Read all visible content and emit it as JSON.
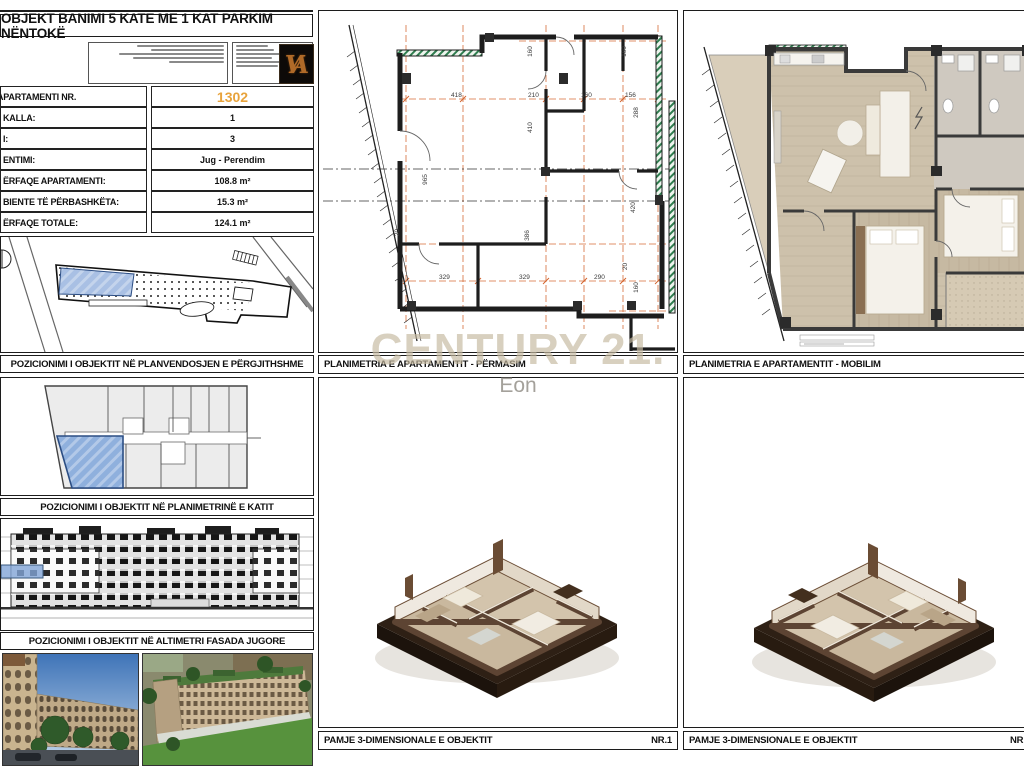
{
  "sheet_title": "OBJEKT BANIMI 5 KATE ME 1 KAT PARKIM NËNTOKË",
  "watermark": {
    "line1": "CENTURY 21.",
    "line2": "Eon"
  },
  "logo_monogram": "VA",
  "info_table": {
    "rows": [
      {
        "label": "APARTAMENTI NR.",
        "value": "1302",
        "accent": true
      },
      {
        "label": "KALLA:",
        "value": "1",
        "accent": false
      },
      {
        "label": "I:",
        "value": "3",
        "accent": false
      },
      {
        "label": "ENTIMI:",
        "value": "Jug - Perendim",
        "accent": false
      },
      {
        "label": "ËRFAQE APARTAMENTI:",
        "value": "108.8 m²",
        "accent": false
      },
      {
        "label": "BIENTE TË PËRBASHKËTA:",
        "value": "15.3 m²",
        "accent": false
      },
      {
        "label": "ËRFAQE TOTALE:",
        "value": "124.1 m²",
        "accent": false
      }
    ]
  },
  "captions": {
    "site_plan": "POZICIONIMI I OBJEKTIT NË PLANVENDOSJEN E PËRGJITHSHME",
    "floor_plan": "POZICIONIMI I OBJEKTIT NË PLANIMETRINË E KATIT",
    "elevation": "POZICIONIMI I OBJEKTIT NË ALTIMETRI FASADA JUGORE",
    "dim_plan": "PLANIMETRIA E APARTAMENTIT - PËRMASIM",
    "furnished_plan": "PLANIMETRIA E APARTAMENTIT - MOBILIM",
    "view3d": "PAMJE 3-DIMENSIONALE E OBJEKTIT",
    "view3d_left_number": "NR.1",
    "view3d_right_number": "NR"
  },
  "colors": {
    "accent_orange": "#E8A33C",
    "grid_orange": "#D4652F",
    "highlight_blue": "#93B1DC",
    "watermark_beige": "#C6BAA1"
  },
  "middle_plan_dimensions": [
    {
      "t": "418",
      "x": 141,
      "y": 86,
      "r": 0
    },
    {
      "t": "210",
      "x": 218,
      "y": 86,
      "r": 0
    },
    {
      "t": "160",
      "x": 271,
      "y": 86,
      "r": 0
    },
    {
      "t": "156",
      "x": 315,
      "y": 86,
      "r": 0
    },
    {
      "t": "160",
      "x": 215,
      "y": 42,
      "r": -90
    },
    {
      "t": "160",
      "x": 309,
      "y": 42,
      "r": -90
    },
    {
      "t": "288",
      "x": 321,
      "y": 103,
      "r": -90
    },
    {
      "t": "410",
      "x": 215,
      "y": 118,
      "r": -90
    },
    {
      "t": "965",
      "x": 110,
      "y": 170,
      "r": -90
    },
    {
      "t": "20",
      "x": 84,
      "y": 223,
      "r": -90
    },
    {
      "t": "386",
      "x": 212,
      "y": 226,
      "r": -90
    },
    {
      "t": "420",
      "x": 318,
      "y": 198,
      "r": -90
    },
    {
      "t": "20",
      "x": 312,
      "y": 257,
      "r": -90
    },
    {
      "t": "160",
      "x": 321,
      "y": 278,
      "r": -90
    },
    {
      "t": "329",
      "x": 129,
      "y": 268,
      "r": 0
    },
    {
      "t": "329",
      "x": 209,
      "y": 268,
      "r": 0
    },
    {
      "t": "290",
      "x": 284,
      "y": 268,
      "r": 0
    }
  ]
}
